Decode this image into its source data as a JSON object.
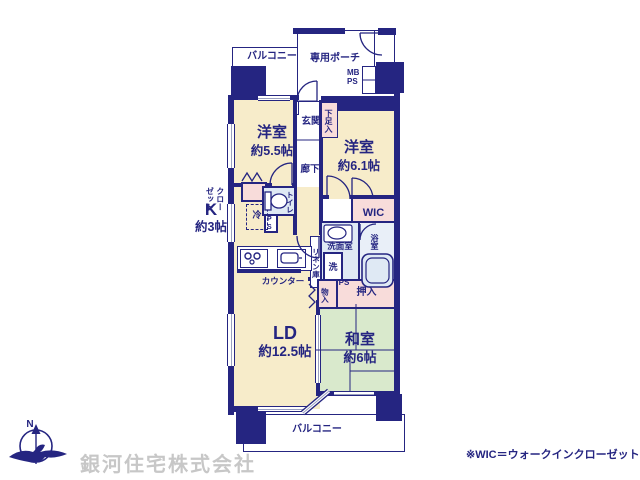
{
  "colors": {
    "wall": "#252581",
    "cream": "#f7ecca",
    "pink": "#f8dcda",
    "blue": "#dfe9f4",
    "bath": "#e9eff8",
    "green": "#d9e9cc"
  },
  "plan": {
    "balcony_top": "バルコニー",
    "porch": "専用ポーチ",
    "mb_ps": "MB\nPS",
    "entrance": "玄関",
    "shoe_box": "下足入",
    "bedroom1": {
      "name": "洋室",
      "size": "約5.5帖"
    },
    "bedroom2": {
      "name": "洋室",
      "size": "約6.1帖"
    },
    "hallway": "廊下",
    "closet": "クロー\nゼット",
    "kitchen": {
      "name": "K",
      "size": "約3帖"
    },
    "fridge": "冷",
    "ps_upper": "PS",
    "toilet": "トイレ",
    "wic": "WIC",
    "washroom": "洗面室",
    "bathroom": "浴室",
    "laundry": "洗",
    "linen": "リネン庫",
    "counter": "カウンター",
    "storage": "物入",
    "ps_lower": "PS",
    "oshiire": "押入",
    "living": {
      "name": "LD",
      "size": "約12.5帖"
    },
    "japanese_room": {
      "name": "和室",
      "size": "約6帖"
    },
    "balcony_bottom": "バルコニー"
  },
  "footer": {
    "company": "銀河住宅株式会社",
    "wic_note": "※WIC＝ウォークインクローゼット",
    "compass_north": "N"
  }
}
